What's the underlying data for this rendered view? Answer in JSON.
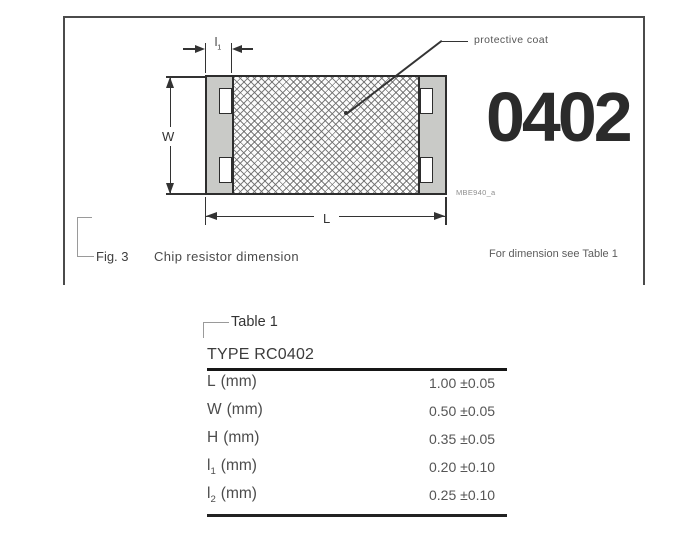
{
  "figure": {
    "annotation_protective_coat": "protective coat",
    "size_code": "0402",
    "drawing_ref": "MBE940_a",
    "dim_w": "W",
    "dim_l": "L",
    "dim_l1_base": "l",
    "dim_l1_sub": "1",
    "fig_label": "Fig. 3",
    "fig_caption": "Chip resistor dimension",
    "note": "For dimension see Table 1"
  },
  "table": {
    "title": "Table 1",
    "type_header": "TYPE RC0402",
    "rows": [
      {
        "base": "L",
        "sub": "",
        "unit": "(mm)",
        "value": "1.00",
        "tolerance": "±0.05"
      },
      {
        "base": "W",
        "sub": "",
        "unit": "(mm)",
        "value": "0.50",
        "tolerance": "±0.05"
      },
      {
        "base": "H",
        "sub": "",
        "unit": "(mm)",
        "value": "0.35",
        "tolerance": "±0.05"
      },
      {
        "base": "l",
        "sub": "1",
        "unit": "(mm)",
        "value": "0.20",
        "tolerance": "±0.10"
      },
      {
        "base": "l",
        "sub": "2",
        "unit": "(mm)",
        "value": "0.25",
        "tolerance": "±0.10"
      }
    ]
  },
  "colors": {
    "line": "#2d2d2d",
    "terminal_fill": "#c9cac7",
    "size_code_text": "#2b2b2b",
    "rule": "#161616"
  }
}
